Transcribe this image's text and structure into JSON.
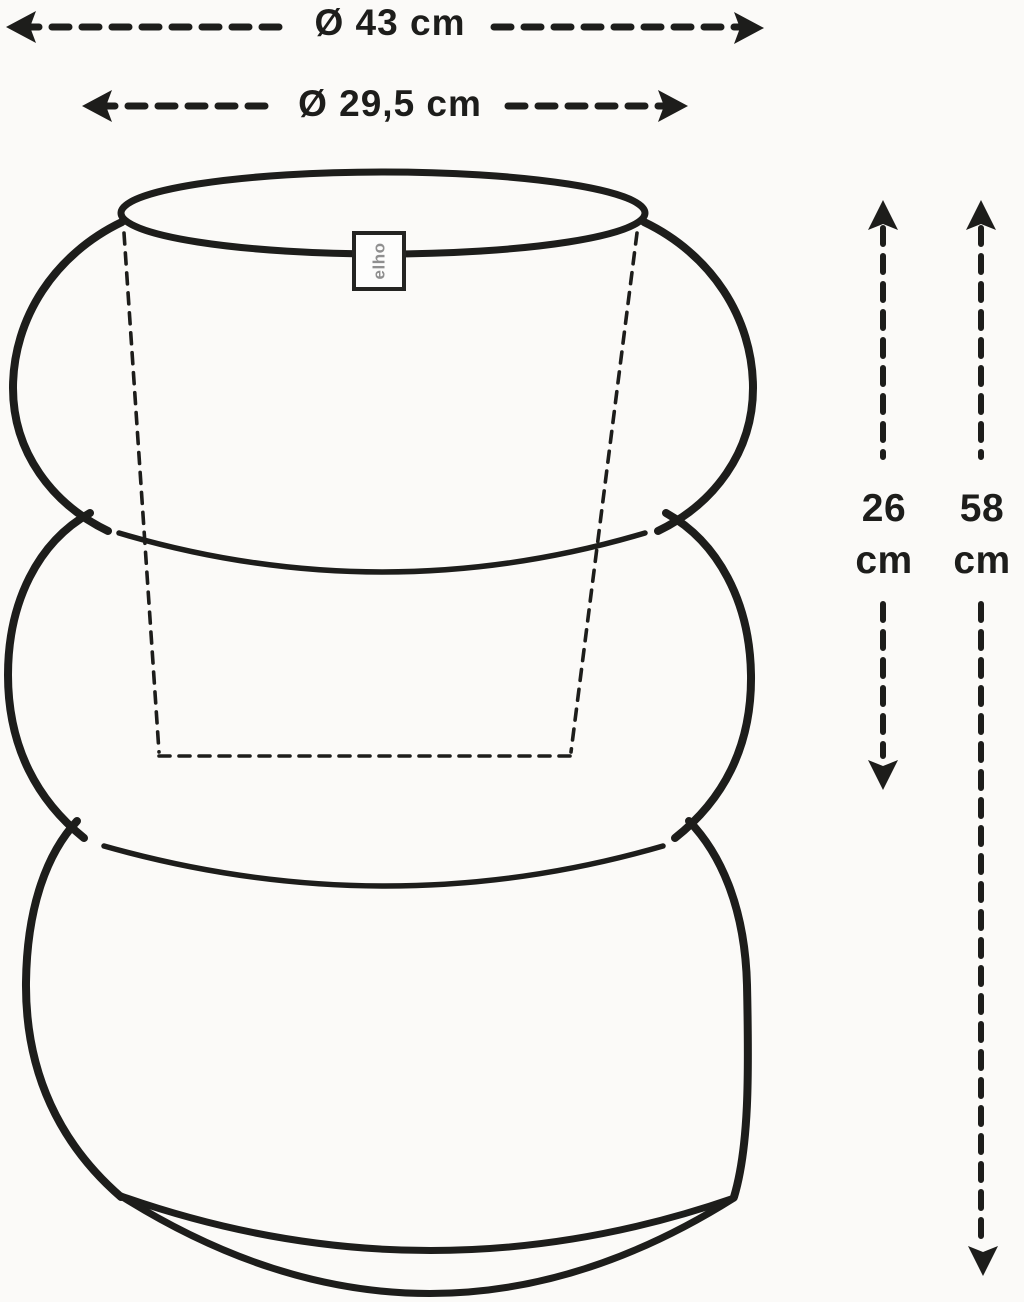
{
  "diagram_title": "planter dimension drawing",
  "colors": {
    "background": "#fbfaf8",
    "ink": "#1d1d1b",
    "brand_gray": "#8f8f8f"
  },
  "dimensions": {
    "outer_diameter": {
      "label": "Ø 43 cm"
    },
    "inner_diameter": {
      "label": "Ø 29,5 cm"
    },
    "inner_height": {
      "value": "26",
      "unit": "cm"
    },
    "total_height": {
      "value": "58",
      "unit": "cm"
    }
  },
  "brand": {
    "label": "elho"
  }
}
